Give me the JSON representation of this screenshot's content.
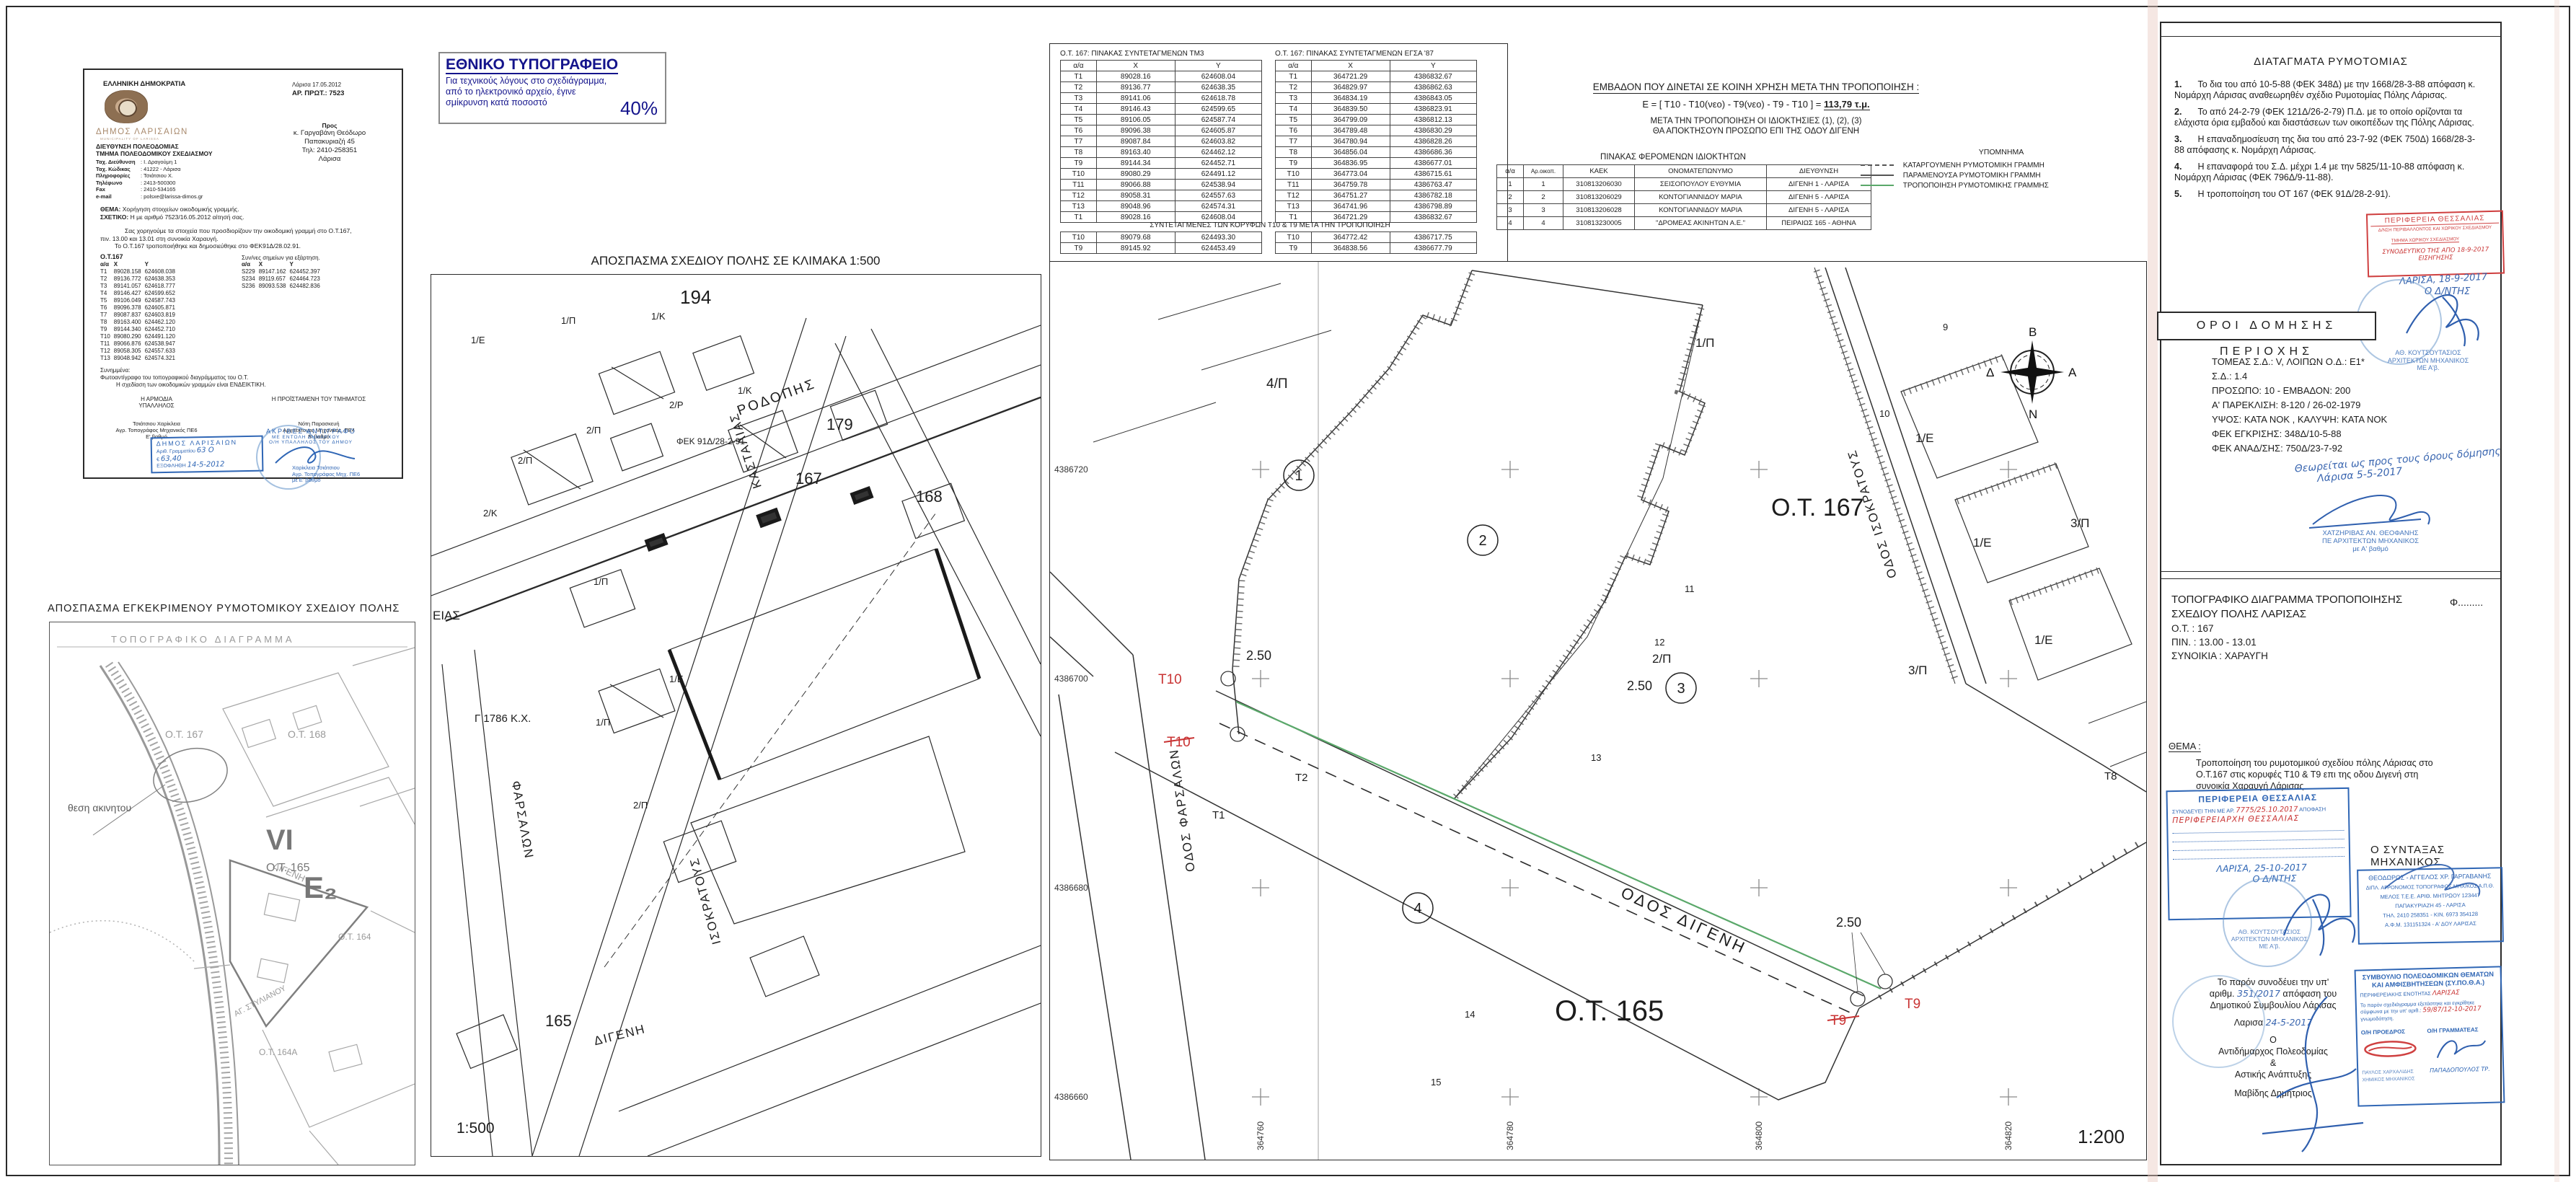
{
  "letter": {
    "republic": "ΕΛΛΗΝΙΚΗ ΔΗΜΟΚΡΑΤΙΑ",
    "municipality": "ΔΗΜΟΣ ΛΑΡΙΣΑΙΩΝ",
    "municipality_en": "MUNICIPALITY OF LARISSA",
    "dept1": "ΔΙΕΥΘΥΝΣΗ ΠΟΛΕΟΔΟΜΙΑΣ",
    "dept2": "ΤΜΗΜΑ ΠΟΛΕΟΔΟΜΙΚΟΥ ΣΧΕΔΙΑΣΜΟΥ",
    "info": [
      {
        "label": "Ταχ. Διεύθυνση",
        "value": ": Ι. Δραγούμη 1"
      },
      {
        "label": "Ταχ. Κώδικας",
        "value": ": 41222 - Λάρισα"
      },
      {
        "label": "Πληροφορίες",
        "value": ": Τσιάτσιου Χ."
      },
      {
        "label": "Τηλέφωνο",
        "value": ": 2413-500300"
      },
      {
        "label": "Fax",
        "value": ": 2410-534165"
      },
      {
        "label": "e-mail",
        "value": ": polsxe@larissa-dimos.gr"
      }
    ],
    "date_line": "Λάρισα  17.05.2012",
    "protocol": "ΑΡ. ΠΡΩΤ.: 7523",
    "to_label": "Προς",
    "to_lines": [
      "κ. Γαργαβάνη Θεόδωρο",
      "Παπακυριαζή 45",
      "Τηλ: 2410-258351",
      "Λάρισα"
    ],
    "thema_label": "ΘΕΜΑ:",
    "thema": "Χορήγηση στοιχείων οικοδομικής γραμμής.",
    "sxetiko_label": "ΣΧΕΤΙΚΟ:",
    "sxetiko": "Η με αριθμό 7523/16.05.2012 αίτησή σας.",
    "body1": "Σας χορηγούμε τα στοιχεία που προσδιορίζουν την οικοδομική γραμμή στο Ο.Τ.167,",
    "body2": "πιν. 13.00 και 13.01 στη συνοικία Χαραυγή.",
    "body3": "Το Ο.Τ.167 τροποποιήθηκε και δημοσιεύθηκε στο ΦΕΚ91Δ/28.02.91.",
    "ot_heading": "Ο.Τ.167",
    "coord_header": [
      "α/α",
      "Χ",
      "Υ"
    ],
    "coords": [
      [
        "Τ1",
        "89028.158",
        "624608.038"
      ],
      [
        "Τ2",
        "89136.772",
        "624638.353"
      ],
      [
        "Τ3",
        "89141.057",
        "624618.777"
      ],
      [
        "Τ4",
        "89146.427",
        "624599.652"
      ],
      [
        "Τ5",
        "89106.049",
        "624587.743"
      ],
      [
        "Τ6",
        "89096.378",
        "624605.871"
      ],
      [
        "Τ7",
        "89087.837",
        "624603.819"
      ],
      [
        "Τ8",
        "89163.400",
        "624462.120"
      ],
      [
        "Τ9",
        "89144.340",
        "624452.710"
      ],
      [
        "Τ10",
        "89080.290",
        "624491.120"
      ],
      [
        "Τ11",
        "89066.876",
        "624538.947"
      ],
      [
        "Τ12",
        "89058.305",
        "624557.633"
      ],
      [
        "Τ13",
        "89048.942",
        "624574.321"
      ]
    ],
    "dep_heading": "Συν/νες σημείων για εξάρτηση.",
    "dep_points": [
      [
        "S229",
        "89147.162",
        "624452.397"
      ],
      [
        "S234",
        "89119.657",
        "624464.723"
      ],
      [
        "S236",
        "89093.538",
        "624482.836"
      ]
    ],
    "attachments_label": "Συνημμένα:",
    "attachment1": "Φωτοαντίγραφο του τοπογραφικού διαγράμματος του Ο.Τ.",
    "attachment2": "Η σχεδίαση των οικοδομικών γραμμών είναι ΕΝΔΕΙΚΤΙΚΗ.",
    "sig_left_role1": "Η ΑΡΜΟΔΙΑ",
    "sig_left_role2": "ΥΠΑΛΛΗΛΟΣ",
    "sig_left_name": "Τσιάτσιου Χαρίκλεια",
    "sig_left_title": "Αγρ. Τοπογράφος Μηχανικός ΠΕ6",
    "sig_left_grade": "Ε' βαθμό",
    "sig_right_role": "Η ΠΡΟΪΣΤΑΜΕΝΗ ΤΟΥ ΤΜΗΜΑΤΟΣ",
    "sig_right_name": "Νότη Παρασκευή",
    "sig_right_title": "Αρχιτέκτονας Μηχανικός, ΠΕ4",
    "sig_right_grade": "Β' βαθμό",
    "fee_stamp": {
      "l1": "ΔΗΜΟΣ ΛΑΡΙΣΑΙΩΝ",
      "l2": "Αριθ. Γραμματίου",
      "v2": "63 Ο",
      "l3": "€",
      "v3": "63,40",
      "l4": "ΕΞΟΦΛΗΘΗ",
      "v4": "14-5-2012"
    },
    "copy_stamp": {
      "l1": "ΑΚΡΙΒΕΣ ΑΝΤΙΓΡΑΦΟ",
      "l2": "ΜΕ ΕΝΤΟΛΗ ΔΗΜΑΡΧΟΥ",
      "l3": "Ο/Η ΥΠΑΛΛΗΛΟΣ ΤΟΥ ΔΗΜΟΥ",
      "n1": "Χαρίκλεια Τσιάτσιου",
      "n2": "Αγρ. Τοπογράφος Μηχ. ΠΕ6",
      "n3": "με Ε' βαθμό"
    }
  },
  "ethniko": {
    "title": "ΕΘΝΙΚΟ ΤΥΠΟΓΡΑΦΕΙΟ",
    "line1": "Για τεχνικούς λόγους στο σχεδιάγραμμα,",
    "line2": "από το ηλεκτρονικό αρχείο, έγινε",
    "line3": "σμίκρυνση κατά ποσοστό",
    "pct": "40%"
  },
  "map500": {
    "title": "ΑΠΟΣΠΑΣΜΑ ΣΧΕΔΙΟΥ ΠΟΛΗΣ ΣΕ ΚΛΙΜΑΚΑ 1:500",
    "scale": "1:500",
    "streets": {
      "rodopis": "ΡΟΔΟΠΗΣ",
      "kastalias": "ΚΑΣΤΑΛΙΑΣ",
      "isokratous": "ΙΣΟΚΡΑΤΟΥΣ",
      "farsalon": "ΦΑΡΣΑΛΩΝ",
      "digeni": "ΔΙΓΕΝΗ",
      "eias": "ΕΙΑΣ"
    },
    "blocks": {
      "b194": "194",
      "b179": "179",
      "b167": "167",
      "b168": "168",
      "b165": "165"
    },
    "fek": "ΦΕΚ 91Δ/28-2-91",
    "kx": "Γ 1786 Κ.Χ.",
    "plots": [
      "1/Ε",
      "1/Π",
      "1/Κ",
      "2/Π",
      "2/Ρ",
      "1/Κ",
      "2/Π",
      "2/Κ",
      "1/Π",
      "1/Π",
      "2/Π",
      "1/Ε"
    ]
  },
  "approved_map": {
    "title": "ΑΠΟΣΠΑΣΜΑ ΕΓΚΕΚΡΙΜΕΝΟΥ ΡΥΜΟΤΟΜΙΚΟΥ ΣΧΕΔΙΟΥ ΠΟΛΗΣ",
    "inner_title": "ΤΟΠΟΓΡΑΦΙΚΟ ΔΙΑΓΡΑΜΜΑ",
    "location": "θεση ακινητου",
    "labels": {
      "ot167": "Ο.Τ. 167",
      "ot168": "Ο.Τ. 168",
      "digeni": "ΔΙΓΕΝΗ",
      "vi": "VI",
      "ot165": "Ο.Τ. 165",
      "e2": "Ε₂",
      "ot164": "Ο.Τ. 164",
      "ot164a": "Ο.Τ. 164Α",
      "agstyl": "ΑΓ. ΣΤΥΛΙΑΝΟΥ"
    }
  },
  "coord_tables": {
    "tm3_title": "Ο.Τ. 167: ΠΙΝΑΚΑΣ ΣΥΝΤΕΤΑΓΜΕΝΩΝ ΤΜ3",
    "egsa_title": "Ο.Τ. 167: ΠΙΝΑΚΑΣ ΣΥΝΤΕΤΑΓΜΕΝΩΝ ΕΓΣΑ '87",
    "header": [
      "α/α",
      "Χ",
      "Υ"
    ],
    "tm3_rows": [
      [
        "Τ1",
        "89028.16",
        "624608.04"
      ],
      [
        "Τ2",
        "89136.77",
        "624638.35"
      ],
      [
        "Τ3",
        "89141.06",
        "624618.78"
      ],
      [
        "Τ4",
        "89146.43",
        "624599.65"
      ],
      [
        "Τ5",
        "89106.05",
        "624587.74"
      ],
      [
        "Τ6",
        "89096.38",
        "624605.87"
      ],
      [
        "Τ7",
        "89087.84",
        "624603.82"
      ],
      [
        "Τ8",
        "89163.40",
        "624462.12"
      ],
      [
        "Τ9",
        "89144.34",
        "624452.71"
      ],
      [
        "Τ10",
        "89080.29",
        "624491.12"
      ],
      [
        "Τ11",
        "89066.88",
        "624538.94"
      ],
      [
        "Τ12",
        "89058.31",
        "624557.63"
      ],
      [
        "Τ13",
        "89048.96",
        "624574.31"
      ],
      [
        "Τ1",
        "89028.16",
        "624608.04"
      ]
    ],
    "egsa_rows": [
      [
        "Τ1",
        "364721.29",
        "4386832.67"
      ],
      [
        "Τ2",
        "364829.97",
        "4386862.63"
      ],
      [
        "Τ3",
        "364834.19",
        "4386843.05"
      ],
      [
        "Τ4",
        "364839.50",
        "4386823.91"
      ],
      [
        "Τ5",
        "364799.09",
        "4386812.13"
      ],
      [
        "Τ6",
        "364789.48",
        "4386830.29"
      ],
      [
        "Τ7",
        "364780.94",
        "4386828.26"
      ],
      [
        "Τ8",
        "364856.04",
        "4386686.36"
      ],
      [
        "Τ9",
        "364836.95",
        "4386677.01"
      ],
      [
        "Τ10",
        "364773.04",
        "4386715.61"
      ],
      [
        "Τ11",
        "364759.78",
        "4386763.47"
      ],
      [
        "Τ12",
        "364751.27",
        "4386782.18"
      ],
      [
        "Τ13",
        "364741.96",
        "4386798.89"
      ],
      [
        "Τ1",
        "364721.29",
        "4386832.67"
      ]
    ],
    "after_title": "ΣΥΝΤΕΤΑΓΜΕΝΕΣ ΤΩΝ ΚΟΡΥΦΩΝ Τ10 & Τ9 ΜΕΤΑ ΤΗΝ ΤΡΟΠΟΠΟΙΗΣΗ",
    "tm3_after": [
      [
        "Τ10",
        "89079.68",
        "624493.30"
      ],
      [
        "Τ9",
        "89145.92",
        "624453.49"
      ]
    ],
    "egsa_after": [
      [
        "Τ10",
        "364772.42",
        "4386717.75"
      ],
      [
        "Τ9",
        "364838.56",
        "4386677.79"
      ]
    ]
  },
  "emvadon": {
    "title": "ΕΜΒΑΔΟΝ ΠΟΥ ΔΙΝΕΤΑΙ ΣΕ ΚΟΙΝΗ ΧΡΗΣΗ ΜΕΤΑ ΤΗΝ ΤΡΟΠΟΠΟΙΗΣΗ :",
    "formula_pre": "Ε = [ Τ10 - Τ10(νεο) - Τ9(νεο) - Τ9 - Τ10 ] =",
    "formula_val": "113,79 τ.μ.",
    "note1": "ΜΕΤΑ ΤΗΝ ΤΡΟΠΟΠΟΙΗΣΗ ΟΙ ΙΔΙΟΚΤΗΣΙΕΣ (1), (2), (3)",
    "note2": "ΘΑ ΑΠΟΚΤΗΣΟΥΝ ΠΡΟΣΩΠΟ ΕΠΙ ΤΗΣ ΟΔΟΥ ΔΙΓΕΝΗ"
  },
  "owners": {
    "title": "ΠΙΝΑΚΑΣ ΦΕΡΟΜΕΝΩΝ ΙΔΙΟΚΤΗΤΩΝ",
    "header": [
      "α/α",
      "Αρ.οικοπ.",
      "ΚΑΕΚ",
      "ΟΝΟΜΑΤΕΠΩΝΥΜΟ",
      "ΔΙΕΥΘΥΝΣΗ"
    ],
    "rows": [
      [
        "1",
        "1",
        "310813206030",
        "ΣΕΙΣΟΠΟΥΛΟΥ ΕΥΘΥΜΙΑ",
        "ΔΙΓΕΝΗ 1 - ΛΑΡΙΣΑ"
      ],
      [
        "2",
        "2",
        "310813206029",
        "ΚΟΝΤΟΓΙΑΝΝΙΔΟΥ ΜΑΡΙΑ",
        "ΔΙΓΕΝΗ 5 - ΛΑΡΙΣΑ"
      ],
      [
        "3",
        "3",
        "310813206028",
        "ΚΟΝΤΟΓΙΑΝΝΙΔΟΥ ΜΑΡΙΑ",
        "ΔΙΓΕΝΗ 5 - ΛΑΡΙΣΑ"
      ],
      [
        "4",
        "4",
        "310813230005",
        "\"ΔΡΟΜΕΑΣ ΑΚΙΝΗΤΩΝ Α.Ε.\"",
        "ΠΕΙΡΑΙΩΣ 165 - ΑΘΗΝΑ"
      ]
    ]
  },
  "legend": {
    "title": "ΥΠΟΜΝΗΜΑ",
    "item1": "ΚΑΤΑΡΓΟΥΜΕΝΗ ΡΥΜΟΤΟΜΙΚΗ ΓΡΑΜΜΗ",
    "item2": "ΠΑΡΑΜΕΝΟΥΣΑ ΡΥΜΟΤΟΜΙΚΗ ΓΡΑΜΜΗ",
    "item3": "ΤΡΟΠΟΠΟΙΗΣΗ ΡΥΜΟΤΟΜΙΚΗΣ ΓΡΑΜΜΗΣ",
    "colors": {
      "dashed": "#555555",
      "solid": "#555555",
      "green": "#5aa86a"
    }
  },
  "plan": {
    "ot167": "Ο.Τ. 167",
    "ot165": "Ο.Τ. 165",
    "road_digeni": "ΟΔΟΣ ΔΙΓΕΝΗ",
    "road_farsalon": "ΟΔΟΣ ΦΑΡΣΑΛΩΝ",
    "road_isokratous": "ΟΔΟΣ ΙΣΟΚΡΑΤΟΥΣ",
    "t10": "Τ10",
    "t9": "Τ9",
    "t1": "Τ1",
    "t2": "Τ2",
    "t8": "Τ8",
    "dim1": "2.50",
    "dim2": "2.50",
    "dim3": "2.50",
    "p_4p": "4/Π",
    "p_1p": "1/Π",
    "p_1e1": "1/Ε",
    "p_1e2": "1/Ε",
    "p_1e3": "1/Ε",
    "p_3p1": "3/Π",
    "p_3p2": "3/Π",
    "p_2p": "2/Π",
    "c1": "1",
    "c2": "2",
    "c3": "3",
    "c4": "4",
    "n9": "9",
    "n10": "10",
    "n11": "11",
    "n12": "12",
    "n13": "13",
    "n14": "14",
    "n15": "15",
    "axis_left": [
      "4386720",
      "4386700",
      "4386680",
      "4386660"
    ],
    "axis_bottom": [
      "364760",
      "364780",
      "364800",
      "364820"
    ],
    "compass": {
      "n": "Β",
      "e": "Α",
      "s": "Ν",
      "w": "Δ"
    },
    "scale": "1:200"
  },
  "right": {
    "diatagmata": {
      "title": "ΔΙΑΤΑΓΜΑΤΑ ΡΥΜΟΤΟΜΙΑΣ",
      "items": [
        {
          "n": "1.",
          "t": "Το δια του από 10-5-88 (ΦΕΚ 348Δ) με την 1668/28-3-88 απόφαση κ. Νομάρχη Λάρισας αναθεωρηθέν σχέδιο Ρυμοτομίας Πόλης Λάρισας."
        },
        {
          "n": "2.",
          "t": "Το από 24-2-79 (ΦΕΚ 121Δ/26-2-79) Π.Δ. με το οποίο ορίζονται τα ελάχιστα όρια εμβαδού και διαστάσεων των οικοπέδων της Πόλης Λάρισας."
        },
        {
          "n": "3.",
          "t": "Η επαναδημοσίευση της δια του από 23-7-92 (ΦΕΚ 750Δ) 1668/28-3-88 απόφασης κ. Νομάρχη Λάρισας."
        },
        {
          "n": "4.",
          "t": "Η επαναφορά του Σ.Δ. μέχρι 1.4 με την 5825/11-10-88 απόφαση κ. Νομάρχη Λάρισας (ΦΕΚ 796Δ/9-11-88)."
        },
        {
          "n": "5.",
          "t": "Η τροποποίηση του ΟΤ 167 (ΦΕΚ 91Δ/28-2-91)."
        }
      ]
    },
    "stamp1": {
      "l1": "ΠΕΡΙΦΕΡΕΙΑ  ΘΕΣΣΑΛΙΑΣ",
      "l2": "Δ/ΝΣΗ ΠΕΡΙΒΑΛΛΟΝΤΟΣ ΚΑΙ ΧΩΡΙΚΟΥ ΣΧΕΔΙΑΣΜΟΥ",
      "l3": "ΤΜΗΜΑ ΧΩΡΙΚΟΥ ΣΧΕΔΙΑΣΜΟΥ",
      "hand": "ΣΥΝΟΔΕΥΤΙΚΟ ΤΗΣ ΑΠΟ 18-9-2017 ΕΙΣΗΓΗΣΗΣ",
      "date": "ΛΑΡΙΣΑ, 18-9-2017",
      "role": "Ο Δ/ΝΤΗΣ",
      "n1": "ΑΘ. ΚΟΥΤΣΟΥΤΑΣΙΟΣ",
      "n2": "ΑΡΧΙΤΕΚΤΩΝ ΜΗΧΑΝΙΚΟΣ",
      "n3": "ΜΕ Α'β."
    },
    "oroi": {
      "title": "ΟΡΟΙ ΔΟΜΗΣΗΣ ΠΕΡΙΟΧΗΣ",
      "lines": [
        "ΤΟΜΕΑΣ Σ.Δ.: V, ΛΟΙΠΩΝ Ο.Δ.: Ε1*",
        "Σ.Δ.: 1.4",
        "ΠΡΟΣΩΠΟ: 10 - ΕΜΒΑΔΟΝ: 200",
        "Α' ΠΑΡΕΚΛΙΣΗ: 8-120 / 26-02-1979",
        "ΥΨΟΣ: ΚΑΤΑ ΝΟΚ , ΚΑΛΥΨΗ: ΚΑΤΑ ΝΟΚ",
        "ΦΕΚ ΕΓΚΡΙΣΗΣ: 348Δ/10-5-88",
        "ΦΕΚ ΑΝΑΔ/ΣΗΣ: 750Δ/23-7-92"
      ],
      "hand1": "Θεωρείται ως προς τους όρους δόμησης",
      "hand2": "Λάρισα 5-5-2017",
      "s1": "ΧΑΤΖΗΡΙΒΑΣ ΑΝ. ΘΕΟΦΑΝΗΣ",
      "s2": "ΠΕ ΑΡΧΙΤΕΚΤΩΝ ΜΗΧΑΝΙΚΟΣ",
      "s3": "με Α' βαθμό"
    },
    "topo": {
      "line1": "ΤΟΠΟΓΡΑΦΙΚΟ ΔΙΑΓΡΑΜΜΑ ΤΡΟΠΟΠΟΙΗΣΗΣ",
      "line2": "ΣΧΕΔΙΟΥ ΠΟΛΗΣ ΛΑΡΙΣΑΣ",
      "ot": "Ο.Τ. : 167",
      "pin": "ΠΙΝ. : 13.00 - 13.01",
      "syn": "ΣΥΝΟΙΚΙΑ : ΧΑΡΑΥΓΗ",
      "phi": "Φ........."
    },
    "thema": {
      "label": "ΘΕΜΑ :",
      "t1": "Τροποποίηση του ρυμοτομικού σχεδίου πόλης Λάρισας στο",
      "t2": "Ο.Τ.167 στις κορυφές Τ10 & Τ9 επι της οδου Διγενή στη",
      "t3": "συνοικία Χαραυγή Λάρισας"
    },
    "stamp2": {
      "title": "ΠΕΡΙΦΕΡΕΙΑ  ΘΕΣΣΑΛΙΑΣ",
      "pre": "ΣΥΝΟΔΕΥΕΙ ΤΗΝ ΜΕ ΑΡ.",
      "ref": "7775/25.10.2017",
      "post": "ΑΠΟΦΑΣΗ",
      "script": "ΠΕΡΙΦΕΡΕΙΑΡΧΗ ΘΕΣΣΑΛΙΑΣ",
      "date": "ΛΑΡΙΣΑ, 25-10-2017",
      "role": "Ο Δ/ΝΤΗΣ",
      "n1": "ΑΘ. ΚΟΥΤΣΟΥΤΑΣΙΟΣ",
      "n2": "ΑΡΧΙΤΕΚΤΩΝ ΜΗΧΑΝΙΚΟΣ",
      "n3": "ΜΕ Α'β."
    },
    "syntaxas": {
      "label": "Ο ΣΥΝΤΑΞΑΣ ΜΗΧΑΝΙΚΟΣ",
      "s1": "ΘΕΟΔΩΡΟΣ - ΑΓΓΕΛΟΣ ΧΡ. ΓΑΡΓΑΒΑΝΗΣ",
      "s2": "ΔΙΠΛ. ΑΓΡΟΝΟΜΟΣ ΤΟΠΟΓΡΑΦΟΣ ΜΗΧ/ΚΟΣ Α.Π.Θ.",
      "s3": "ΜΕΛΟΣ Τ.Ε.Ε. ΑΡΙΘ. ΜΗΤΡΩΟΥ 123447",
      "s4": "ΠΑΠΑΚΥΡΙΑΖΗ 45 - ΛΑΡΙΣΑ",
      "s5": "ΤΗΛ. 2410 258351 - ΚΙΝ. 6973 354128",
      "s6": "Α.Φ.Μ. 131151324 - Α' ΔΟΥ ΛΑΡΙΣΑΣ"
    },
    "council": {
      "l1": "Το παρόν συνοδέυει την υπ'",
      "l2a": "αριθμ.",
      "num": "351/2017",
      "l2b": "απόφαση του",
      "l3": "Δημοτικού Συμβουλίου Λάρισας",
      "city": "Λαρισα",
      "date": "24-5-2017",
      "o": "Ο",
      "role1": "Αντιδήμαρχος Πολεοδομίας",
      "amp": "&",
      "role2": "Αστικής Ανάπτυξης",
      "name": "Μαβίδης Δημήτριος"
    },
    "sypotha": {
      "t1": "ΣΥΜΒΟΥΛΙΟ ΠΟΛΕΟΔΟΜΙΚΩΝ ΘΕΜΑΤΩΝ",
      "t2": "ΚΑΙ ΑΜΦΙΣΒΗΤΗΣΕΩΝ (ΣΥ.ΠΟ.Θ.Α.)",
      "t3": "ΠΕΡΙΦΕΡΕΙΑΚΗΣ ΕΝΟΤΗΤΑΣ",
      "region": "ΛΑΡΙΣΑΣ",
      "b1": "Το παρόν σχεδιάγραμμα εξετάστηκε και εγκρίθηκε",
      "b2": "σύμφωνα με την υπ' αριθ.:",
      "ref": "59/87/12-10-2017",
      "b3": "γνωμοδότηση.",
      "pres": "Ο/Η ΠΡΟΕΔΡΟΣ",
      "secr": "Ο/Η ΓΡΑΜΜΑΤΕΑΣ",
      "pres_name": "ΠΑΥΛΟΣ ΧΑΡΧΑΛΙΔΗΣ",
      "pres_title": "ΧΗΜΙΚΟΣ ΜΗΧΑΝΙΚΟΣ",
      "secr_name": "ΠΑΠΑΔΟΠΟΥΛΟΣ ΤΡ."
    }
  }
}
